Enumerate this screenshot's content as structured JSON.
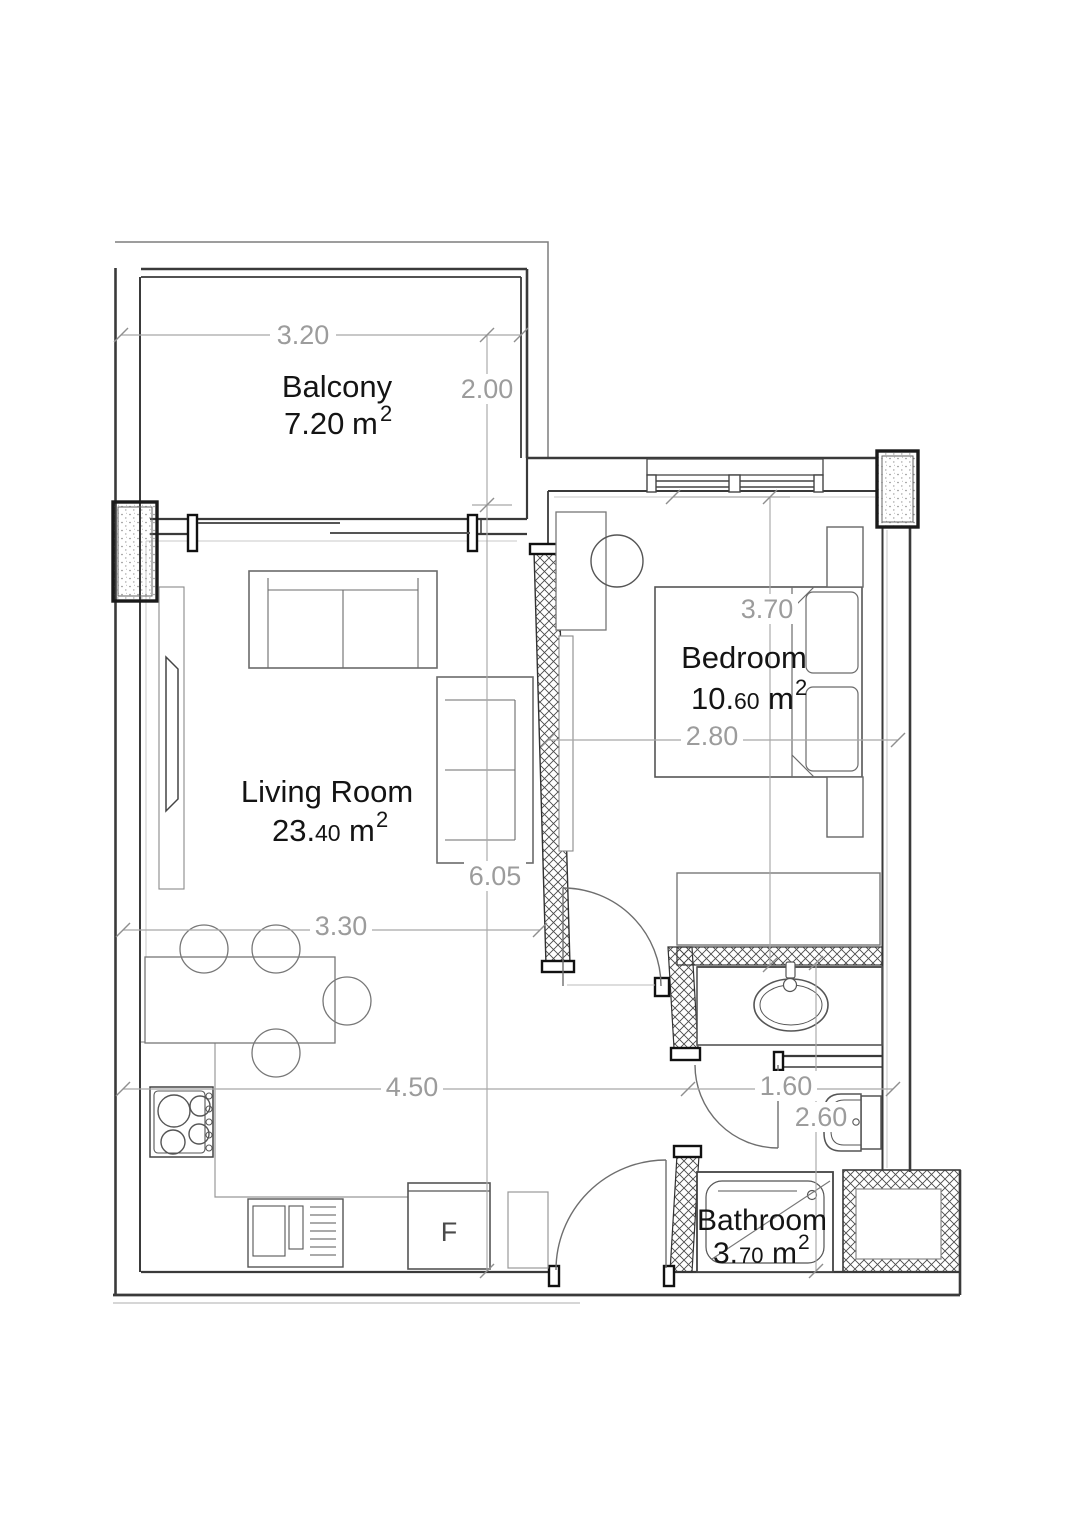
{
  "plan_title": "Apartment floor plan",
  "rooms": {
    "balcony": {
      "name": "Balcony",
      "area_int": "7.20",
      "area_dec": "",
      "area_unit": "m",
      "area_sup": "2"
    },
    "living": {
      "name": "Living Room",
      "area_int": "23.",
      "area_dec": "40",
      "area_unit": "m",
      "area_sup": "2"
    },
    "bedroom": {
      "name": "Bedroom",
      "area_int": "10.",
      "area_dec": "60",
      "area_unit": "m",
      "area_sup": "2"
    },
    "bathroom": {
      "name": "Bathroom",
      "area_int": "3.",
      "area_dec": "70",
      "area_unit": "m",
      "area_sup": "2"
    }
  },
  "dims": {
    "balcony_width": "3.20",
    "balcony_depth": "2.00",
    "bedroom_length": "3.70",
    "bedroom_width": "2.80",
    "living_length": "6.05",
    "living_width": "3.30",
    "kitchen_run": "4.50",
    "bathroom_width": "1.60",
    "bathroom_length": "2.60"
  },
  "labels": {
    "fridge": "F"
  },
  "colors": {
    "wall": "#3a3a3a",
    "furniture": "#6b6b6b",
    "dimension": "#a8a8a8",
    "text": "#141414"
  }
}
